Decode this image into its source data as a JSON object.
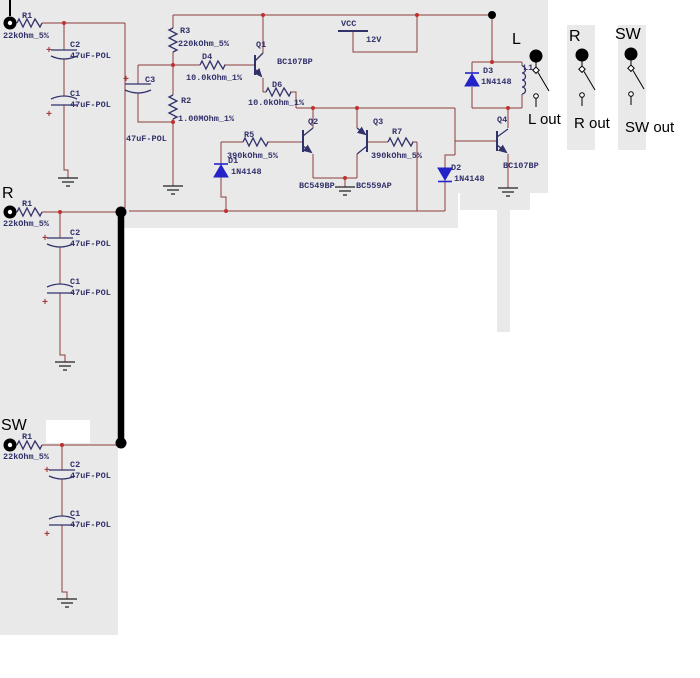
{
  "colors": {
    "wire": "#8b3d3b",
    "component": "#32326b",
    "label_text": "#32326b",
    "diode": "#2323c8",
    "junction": "#c03030",
    "background": "#ffffff",
    "panel_gray": "#e9e9e9",
    "annotation": "#000000"
  },
  "power": {
    "net": "VCC",
    "voltage": "12V"
  },
  "inputs": {
    "l": {
      "r_ref": "R1",
      "r_val": "22kOhm_5%",
      "c2_ref": "C2",
      "c2_val": "47uF-POL",
      "c1_ref": "C1",
      "c1_val": "47uF-POL"
    },
    "r": {
      "section": "R",
      "r_ref": "R1",
      "r_val": "22kOhm_5%",
      "c2_ref": "C2",
      "c2_val": "47uF-POL",
      "c1_ref": "C1",
      "c1_val": "47uF-POL"
    },
    "sw": {
      "section": "SW",
      "r_ref": "R1",
      "r_val": "22kOhm_5%",
      "c2_ref": "C2",
      "c2_val": "47uF-POL",
      "c1_ref": "C1",
      "c1_val": "47uF-POL"
    }
  },
  "components": {
    "r3": {
      "ref": "R3",
      "val": "220kOhm_5%"
    },
    "d4": {
      "ref": "D4",
      "val": "10.0kOhm_1%"
    },
    "r2": {
      "ref": "R2",
      "val": "1.00MOhm_1%"
    },
    "c3": {
      "ref": "C3",
      "val": "47uF-POL"
    },
    "q1": {
      "ref": "Q1",
      "val": "BC107BP"
    },
    "d6": {
      "ref": "D6",
      "val": "10.0kOhm_1%"
    },
    "q2": {
      "ref": "Q2",
      "val": "BC549BP"
    },
    "q3": {
      "ref": "Q3",
      "val": "BC559AP"
    },
    "r5": {
      "ref": "R5",
      "val": "390kOhm_5%"
    },
    "r7": {
      "ref": "R7",
      "val": "390kOhm_5%"
    },
    "d1": {
      "ref": "D1",
      "val": "1N4148"
    },
    "d2": {
      "ref": "D2",
      "val": "1N4148"
    },
    "d3": {
      "ref": "D3",
      "val": "1N4148"
    },
    "l1": {
      "ref": "L1"
    },
    "q4": {
      "ref": "Q4",
      "val": "BC107BP"
    }
  },
  "switches": {
    "l": {
      "label": "L",
      "out": "L out"
    },
    "r": {
      "label": "R",
      "out": "R out"
    },
    "sw": {
      "label": "SW",
      "out": "SW out"
    }
  },
  "symbols": {
    "plus": "+"
  }
}
